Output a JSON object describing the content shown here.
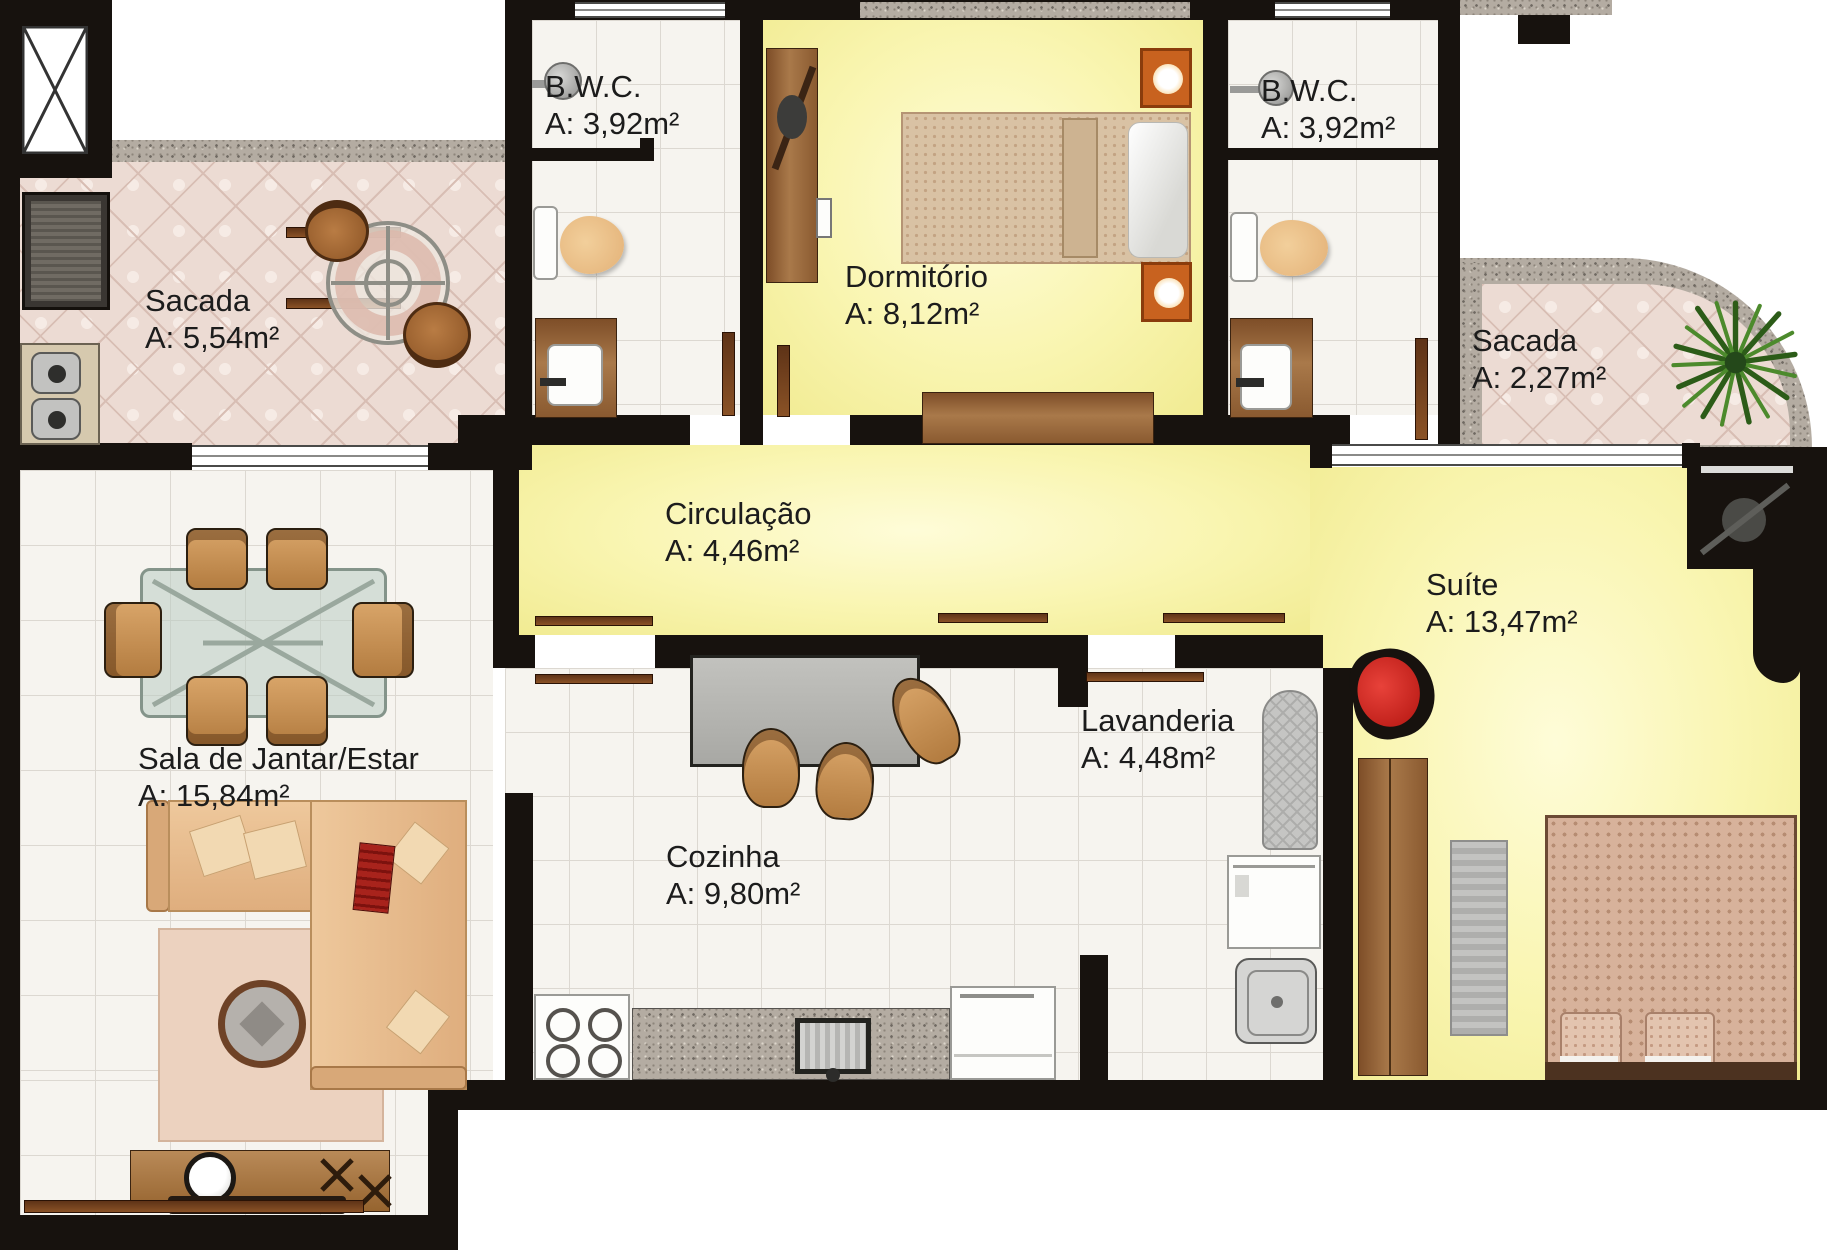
{
  "floorplan": {
    "type": "apartment-floor-plan",
    "rooms": [
      {
        "id": "sacada-1",
        "name": "Sacada",
        "area": "A: 5,54m²"
      },
      {
        "id": "bwc-1",
        "name": "B.W.C.",
        "area": "A: 3,92m²"
      },
      {
        "id": "dormitorio",
        "name": "Dormitório",
        "area": "A: 8,12m²"
      },
      {
        "id": "bwc-2",
        "name": "B.W.C.",
        "area": "A: 3,92m²"
      },
      {
        "id": "sacada-2",
        "name": "Sacada",
        "area": "A: 2,27m²"
      },
      {
        "id": "circulacao",
        "name": "Circulação",
        "area": "A: 4,46m²"
      },
      {
        "id": "suite",
        "name": "Suíte",
        "area": "A: 13,47m²"
      },
      {
        "id": "sala",
        "name": "Sala de Jantar/Estar",
        "area": "A: 15,84m²"
      },
      {
        "id": "cozinha",
        "name": "Cozinha",
        "area": "A: 9,80m²"
      },
      {
        "id": "lavanderia",
        "name": "Lavanderia",
        "area": "A: 4,48m²"
      }
    ],
    "colors": {
      "wall": "#17120e",
      "yellow_floor": "#f7f3a6",
      "tile_floor": "#f6f4ef",
      "balcony_tile": "#ecdbd3",
      "granite": "#b4aca2",
      "wood": "#8a5a30",
      "accent_red": "#cf2a22",
      "plant_green": "#35691f",
      "label_text": "#1c1c1c"
    },
    "icons": {
      "elevator_shaft_icon": "crossed-box",
      "shower_icon": "round-head-with-arm",
      "ceiling_fan_icon": "circle-with-blade",
      "plant_icon": "leaf-starburst",
      "door_icon": "wood-leaf",
      "window_icon": "triple-line-strip"
    }
  }
}
